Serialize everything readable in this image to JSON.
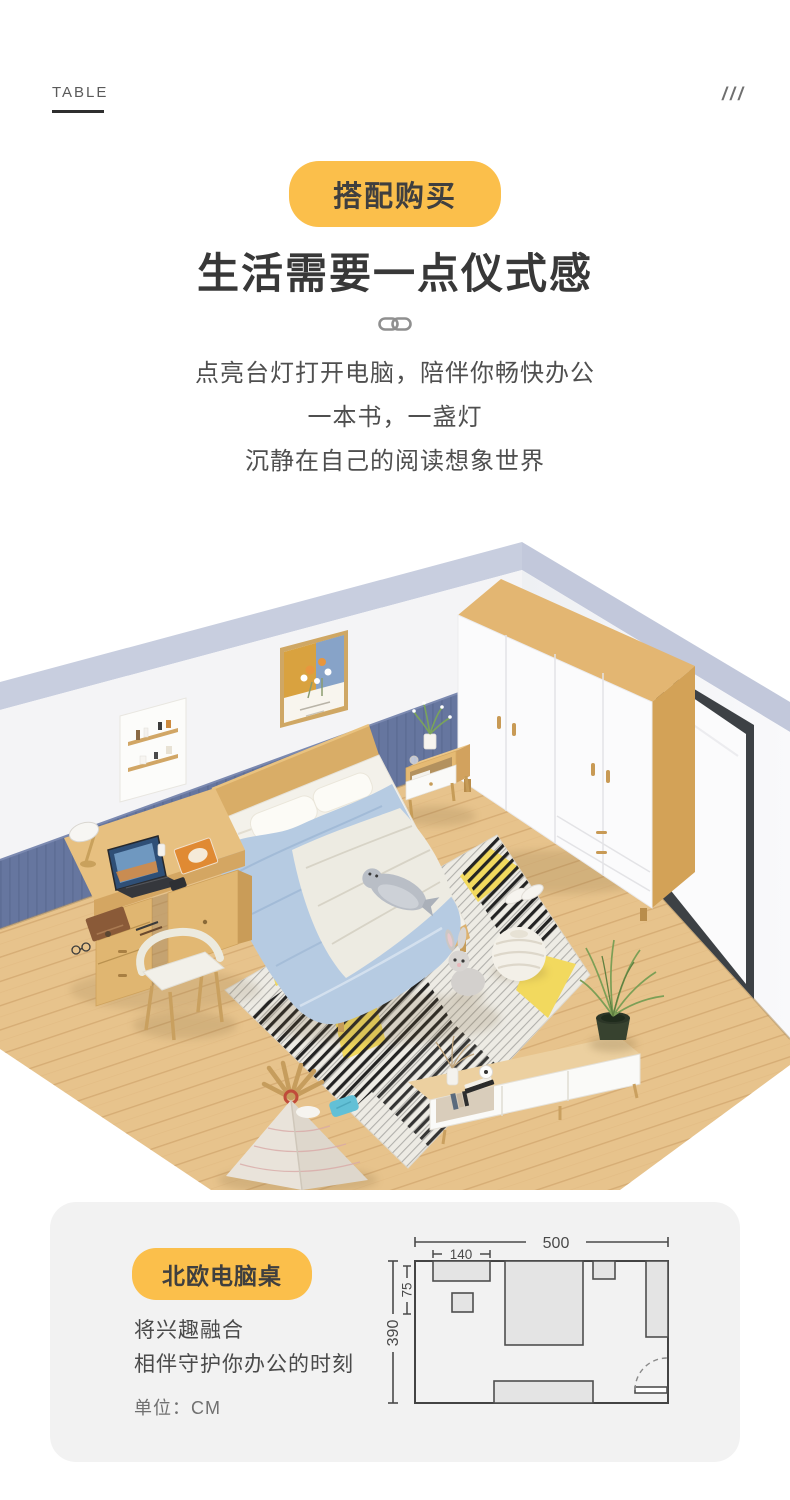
{
  "page": {
    "background": "#ffffff"
  },
  "header": {
    "eyebrow": "TABLE",
    "decor_slashes": "///",
    "badge_label": "搭配购买",
    "title": "生活需要一点仪式感",
    "subtitle_lines": [
      "点亮台灯打开电脑，陪伴你畅快办公",
      "一本书，一盏灯",
      "沉静在自己的阅读想象世界"
    ]
  },
  "product_card": {
    "badge_label": "北欧电脑桌",
    "desc_lines": [
      "将兴趣融合",
      "相伴守护你办公的时刻"
    ],
    "unit_label": "单位：CM",
    "floorplan": {
      "room_width_cm": "500",
      "desk_width_cm": "140",
      "desk_depth_cm": "75",
      "room_depth_cm": "390"
    }
  },
  "colors": {
    "accent": "#FBBF4B",
    "card_background": "#F2F2F2",
    "plan_line": "#4A4A4A",
    "plan_fill": "#E4E4E4",
    "wall_trim": "#C8CEDF",
    "wainscot_blue": "#66769F",
    "wood": "#E0B471",
    "floor": "#E7C38C"
  }
}
